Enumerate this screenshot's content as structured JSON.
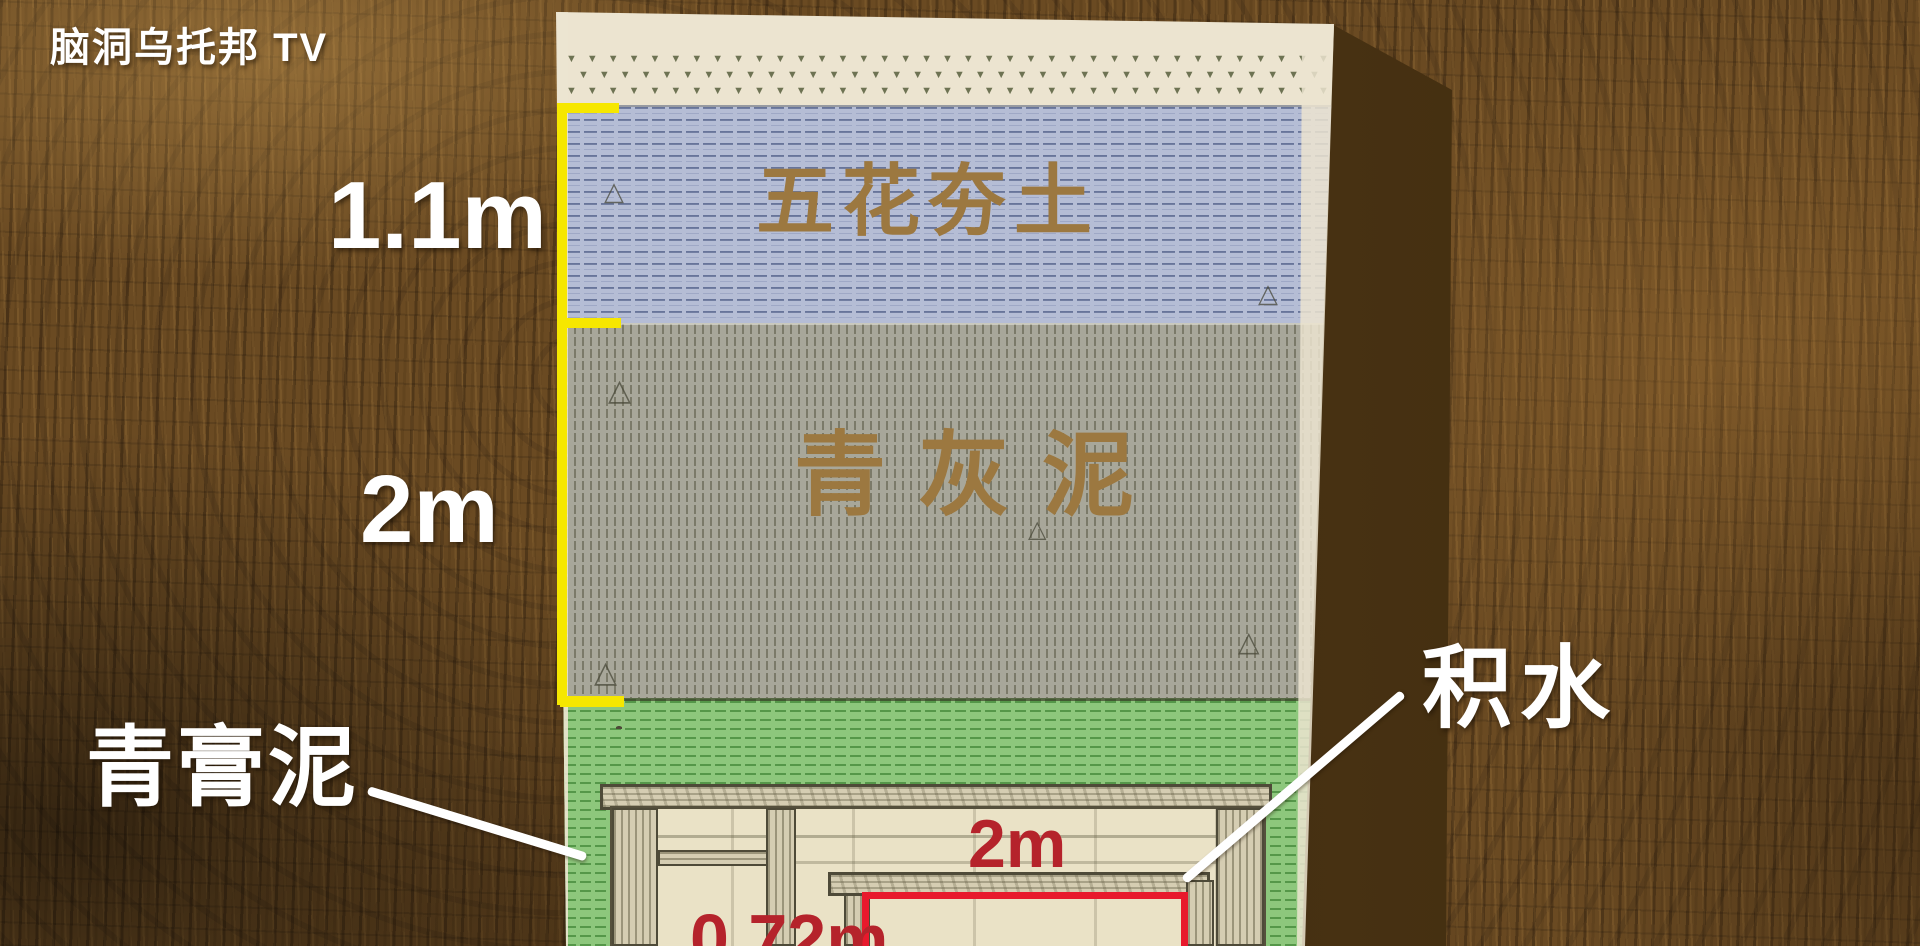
{
  "watermark": {
    "text": "脑洞乌托邦 TV"
  },
  "diagram": {
    "strata": [
      {
        "name": "surface-turf",
        "label": "",
        "depth_label": ""
      },
      {
        "name": "rammed-earth",
        "label": "五花夯土",
        "depth_label": "1.1m",
        "color": "#b5bdd5"
      },
      {
        "name": "gray-mud",
        "label": "青灰泥",
        "depth_label": "2m",
        "color": "#a8a79a"
      },
      {
        "name": "green-paste-clay",
        "label": "青膏泥",
        "color": "#8dc77c"
      }
    ],
    "callouts": {
      "green_clay": "青膏泥",
      "water": "积水"
    },
    "tomb": {
      "chamber_width_label": "2m",
      "coffin_width_label": "0.72m"
    },
    "colors": {
      "bracket_yellow": "#f6e700",
      "measure_red": "#b5232b",
      "coffin_outline_red": "#e8192c",
      "stratum_label_brown": "#9c7840",
      "shadow_brown": "#3c280e",
      "callout_white": "#ffffff"
    },
    "pattern_glyphs": {
      "grass": "▼",
      "triangle": "△"
    }
  }
}
